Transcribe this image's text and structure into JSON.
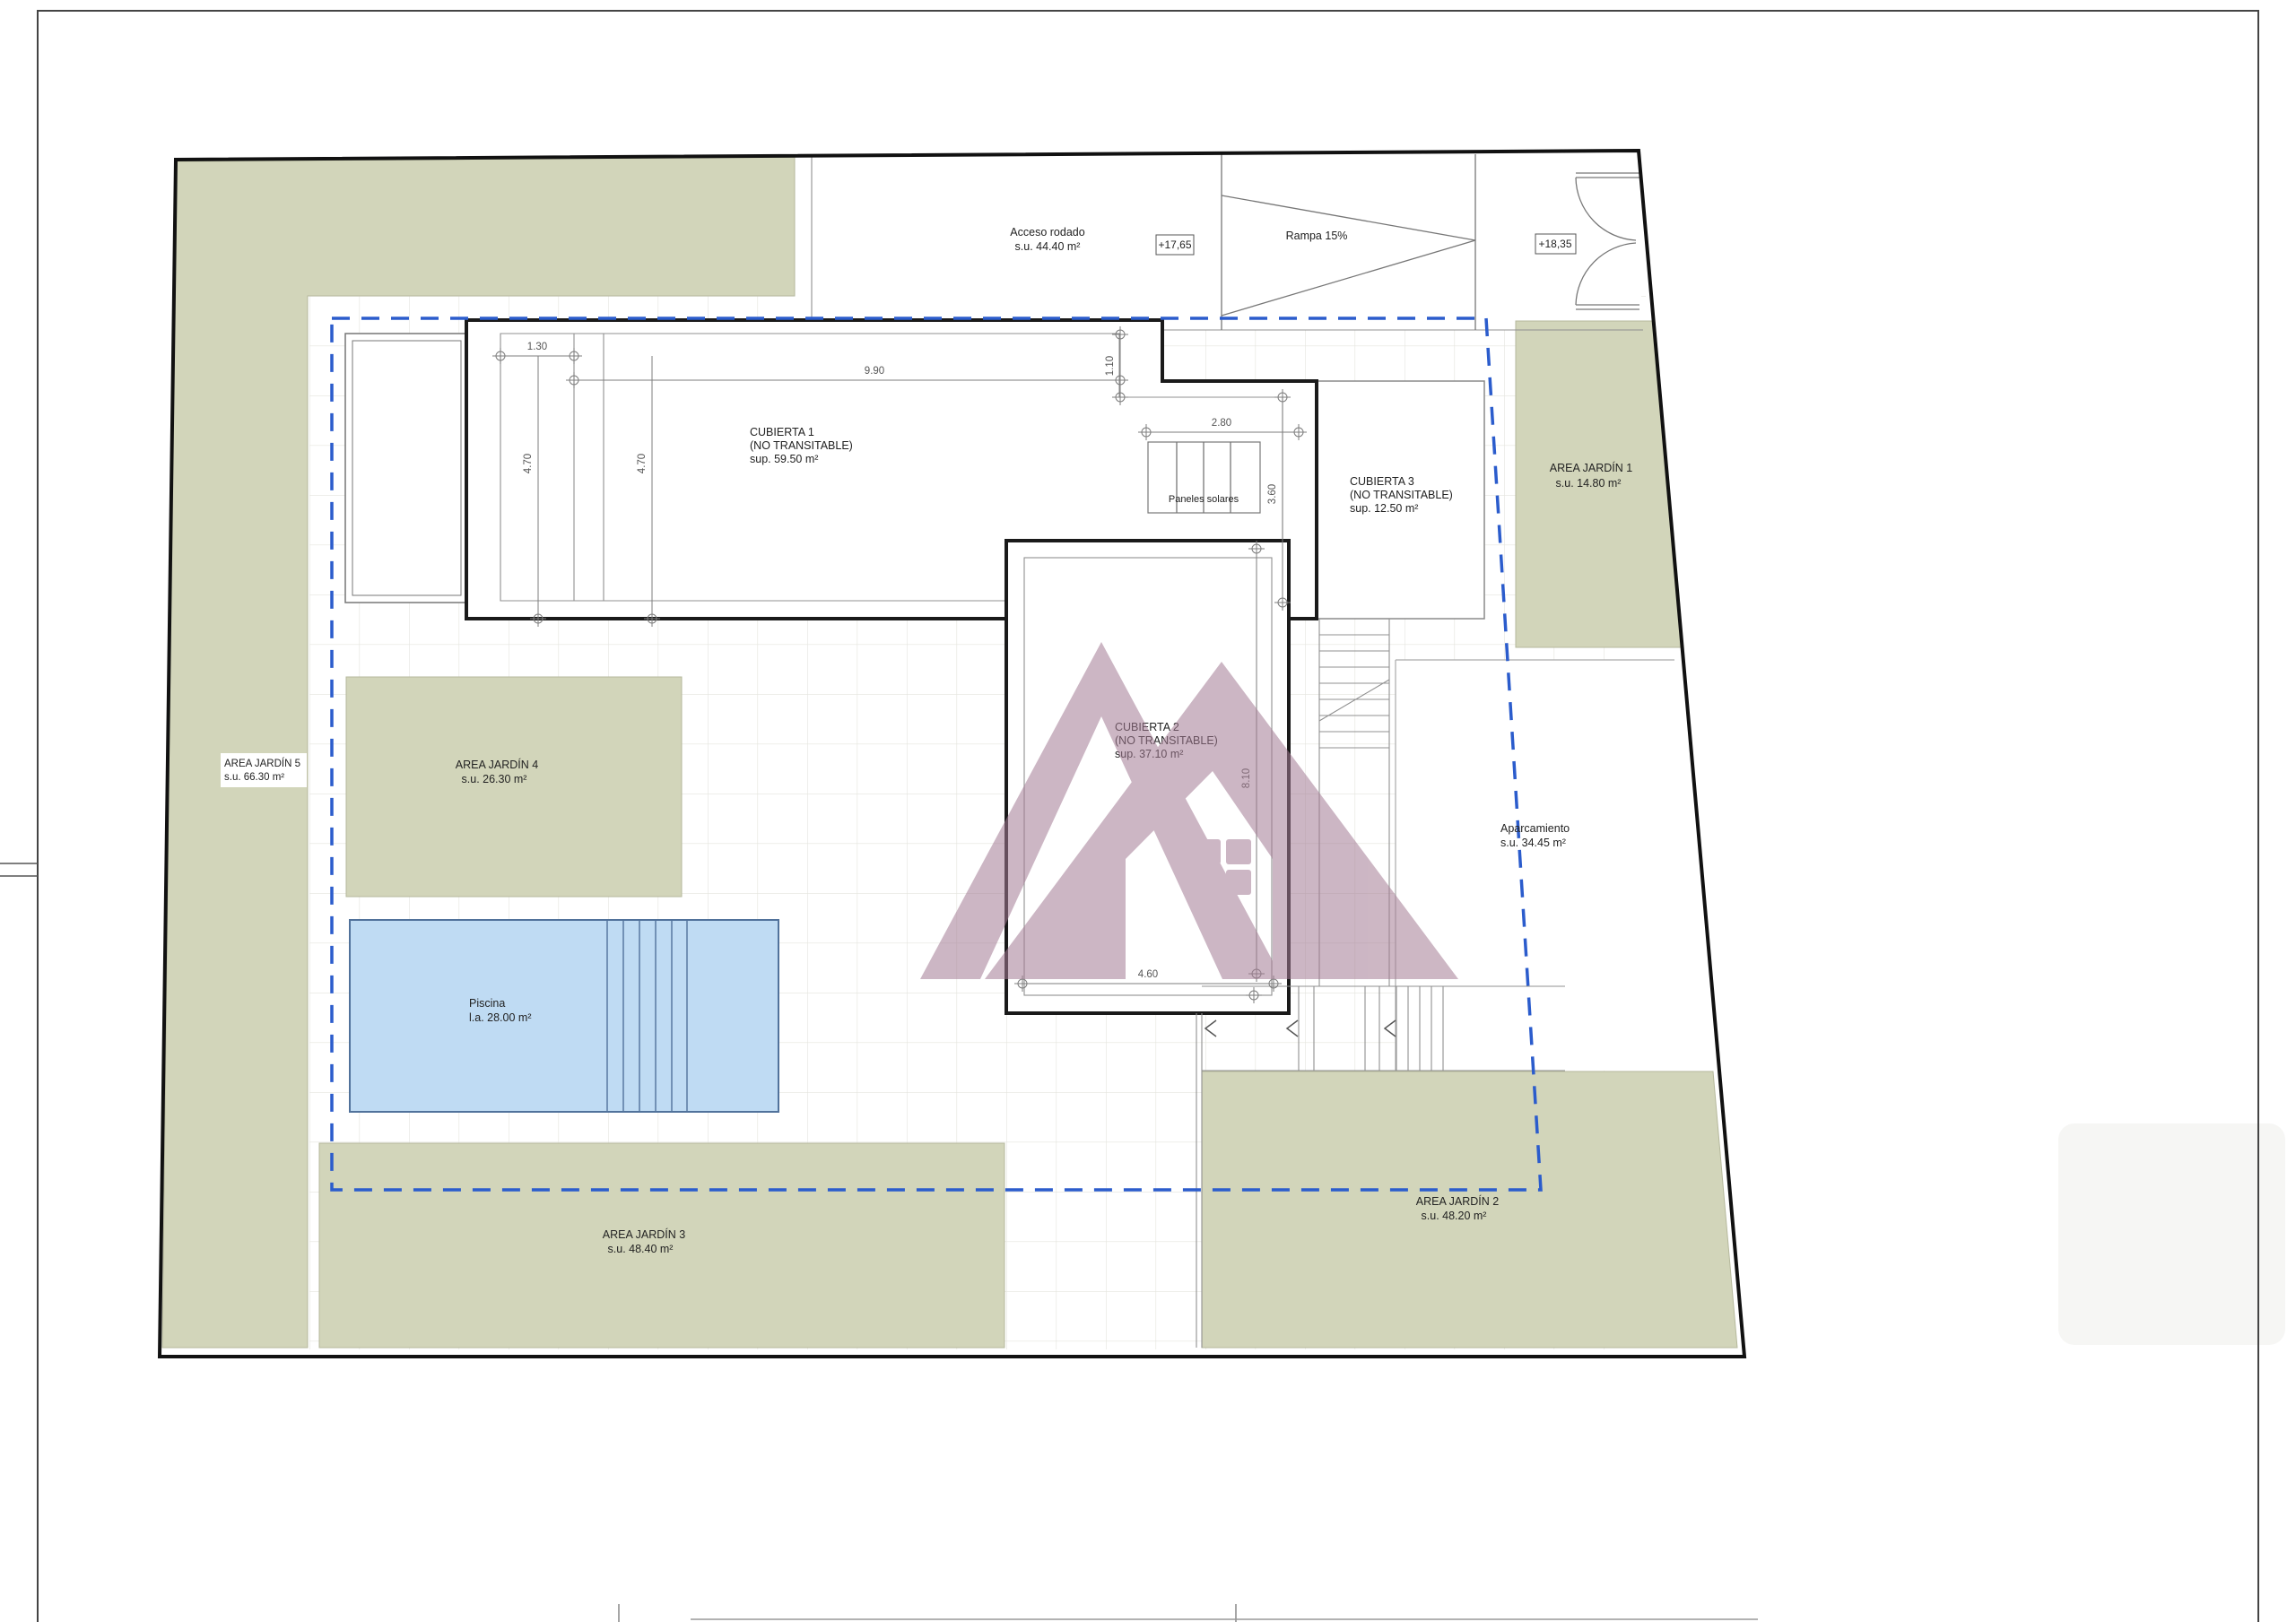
{
  "drawing_type": "site roof plan (planta de cubiertas)",
  "colors": {
    "garden": "#d2d5ba",
    "pool": "#bfdbf3",
    "pool_border": "#51729b",
    "setback_dashed": "#2b5ccc",
    "outline_thick": "#1a1a1a",
    "thin_line": "#909090",
    "grid": "#e4e4de",
    "dim_text": "#555555",
    "label_text": "#222222",
    "watermark_base": "#a47c94"
  },
  "labels": {
    "acceso": {
      "name": "Acceso rodado",
      "area": "s.u. 44.40 m²"
    },
    "rampa": {
      "name": "Rampa 15%"
    },
    "level_entrance": "+17,65",
    "level_gate": "+18,35",
    "cubierta1": {
      "name": "CUBIERTA 1",
      "note": "(NO TRANSITABLE)",
      "area": "sup. 59.50 m²"
    },
    "cubierta2": {
      "name": "CUBIERTA 2",
      "note": "(NO TRANSITABLE)",
      "area": "sup. 37.10 m²"
    },
    "cubierta3": {
      "name": "CUBIERTA 3",
      "note": "(NO TRANSITABLE)",
      "area": "sup. 12.50 m²"
    },
    "paneles": "Paneles solares",
    "aparcamiento": {
      "name": "Aparcamiento",
      "area": "s.u. 34.45 m²"
    },
    "piscina": {
      "name": "Piscina",
      "area": "l.a. 28.00 m²"
    },
    "jardin1": {
      "name": "AREA JARDÍN 1",
      "area": "s.u. 14.80 m²"
    },
    "jardin2": {
      "name": "AREA JARDÍN 2",
      "area": "s.u. 48.20 m²"
    },
    "jardin3": {
      "name": "AREA JARDÍN 3",
      "area": "s.u. 48.40 m²"
    },
    "jardin4": {
      "name": "AREA JARDÍN 4",
      "area": "s.u. 26.30 m²"
    },
    "jardin5": {
      "name": "AREA JARDÍN 5",
      "area": "s.u. 66.30 m²"
    }
  },
  "dimensions": {
    "d130": "1.30",
    "d990": "9.90",
    "d110": "1.10",
    "d470a": "4.70",
    "d470b": "4.70",
    "d280": "2.80",
    "d360": "3.60",
    "d810": "8.10",
    "d460": "4.60"
  }
}
